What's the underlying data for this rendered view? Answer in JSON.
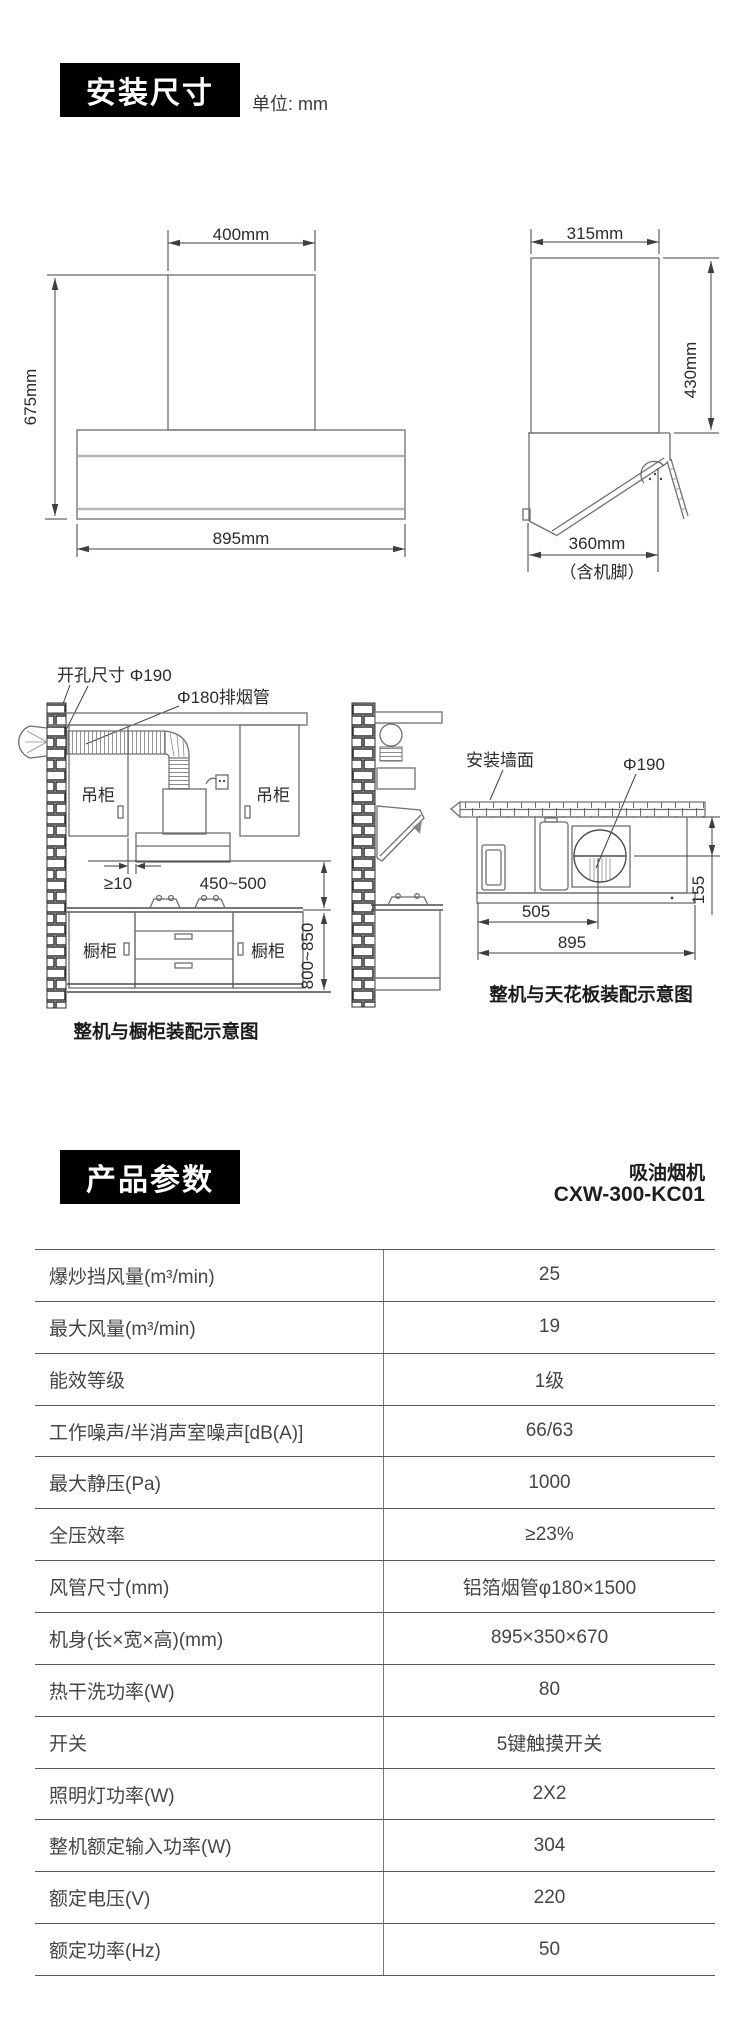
{
  "install": {
    "badge_label": "安装尺寸",
    "unit_label": "单位: mm",
    "front": {
      "top": "400mm",
      "left": "675mm",
      "bottom": "895mm"
    },
    "side": {
      "top": "315mm",
      "right": "430mm",
      "bottom": "360mm",
      "note": "（含机脚）"
    },
    "cabinet": {
      "hole": "开孔尺寸 Φ190",
      "pipe": "Φ180排烟管",
      "hang_l": "吊柜",
      "hang_r": "吊柜",
      "base_l": "橱柜",
      "base_r": "橱柜",
      "gap": "≥10",
      "range": "450~500",
      "height": "800~850",
      "caption": "整机与橱柜装配示意图"
    },
    "ceiling": {
      "wall": "安装墙面",
      "hole": "Φ190",
      "d505": "505",
      "d895": "895",
      "d155": "155",
      "caption": "整机与天花板装配示意图"
    }
  },
  "params": {
    "badge_label": "产品参数",
    "product_type": "吸油烟机",
    "model": "CXW-300-KC01",
    "rows": [
      {
        "label": "爆炒挡风量(m³/min)",
        "value": "25"
      },
      {
        "label": "最大风量(m³/min)",
        "value": "19"
      },
      {
        "label": "能效等级",
        "value": "1级"
      },
      {
        "label": "工作噪声/半消声室噪声[dB(A)]",
        "value": "66/63"
      },
      {
        "label": "最大静压(Pa)",
        "value": "1000"
      },
      {
        "label": "全压效率",
        "value": "≥23%"
      },
      {
        "label": "风管尺寸(mm)",
        "value": "铝箔烟管φ180×1500"
      },
      {
        "label": "机身(长×宽×高)(mm)",
        "value": "895×350×670"
      },
      {
        "label": "热干洗功率(W)",
        "value": "80"
      },
      {
        "label": "开关",
        "value": "5键触摸开关"
      },
      {
        "label": "照明灯功率(W)",
        "value": "2X2"
      },
      {
        "label": "整机额定输入功率(W)",
        "value": "304"
      },
      {
        "label": "额定电压(V)",
        "value": "220"
      },
      {
        "label": "额定功率(Hz)",
        "value": "50"
      }
    ]
  }
}
